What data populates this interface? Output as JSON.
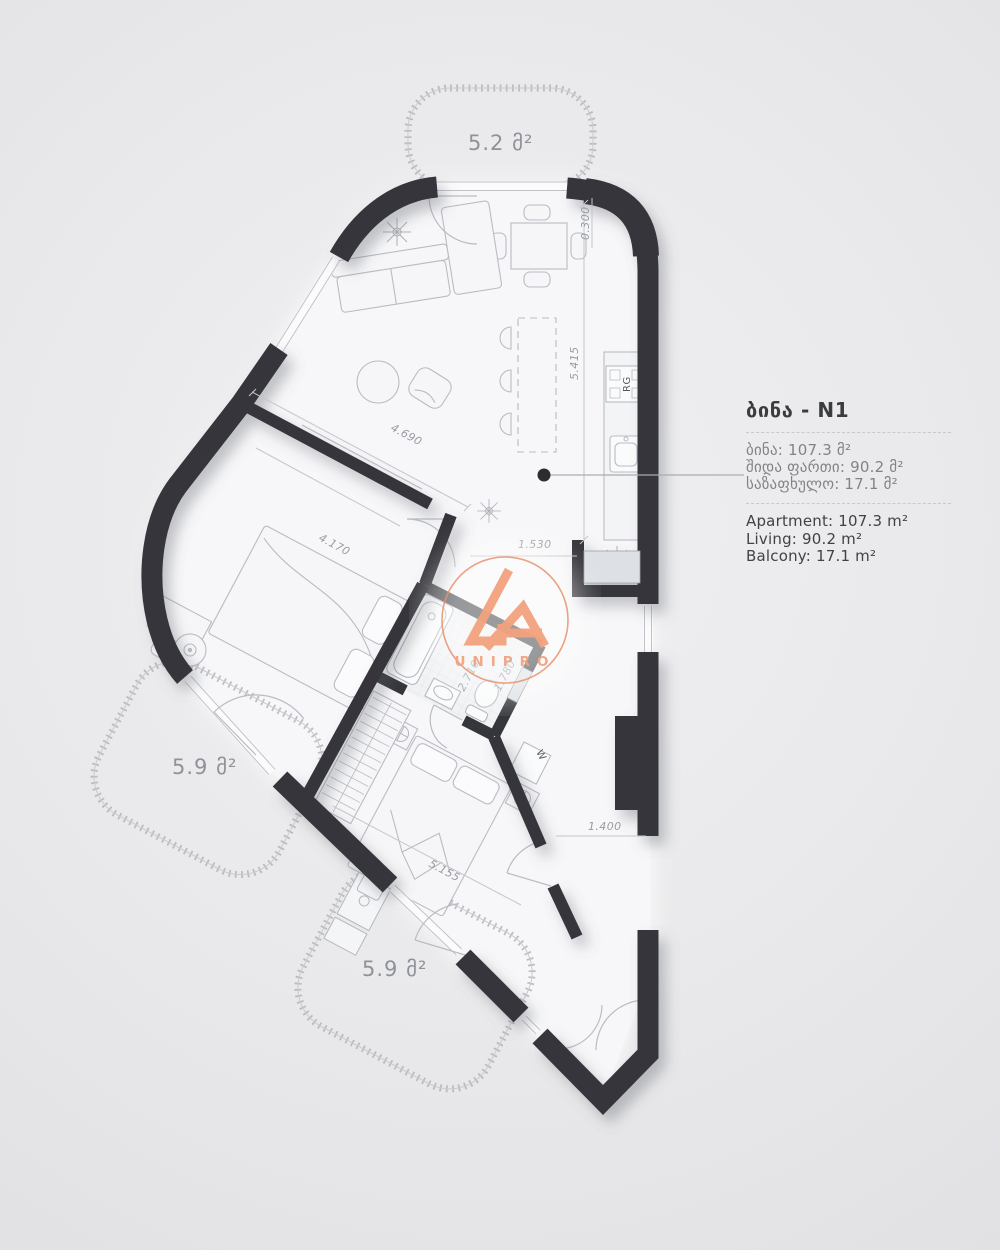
{
  "colors": {
    "background": "#e9e9eb",
    "wall": "#34363b",
    "accent": "#f0a07c",
    "line": "#b9bcc3"
  },
  "plan": {
    "balconies": [
      {
        "id": "top",
        "label": "5.2 მ²"
      },
      {
        "id": "left",
        "label": "5.9 მ²"
      },
      {
        "id": "bottom",
        "label": "5.9 მ²"
      }
    ],
    "dimensions": [
      "4.690",
      "4.170",
      "5.415",
      "0.300",
      "1.530",
      "2.710",
      "1.780",
      "5.155",
      "1.400"
    ],
    "appliances": {
      "range": "RG",
      "washer": "W"
    }
  },
  "logo": {
    "name": "UNIPRO"
  },
  "panel": {
    "title": "ბინა - N1",
    "lines_ka": [
      "ბინა: 107.3 მ²",
      "შიდა ფართი: 90.2 მ²",
      "საზაფხულო: 17.1 მ²"
    ],
    "lines_en": [
      "Apartment: 107.3 m²",
      "Living: 90.2 m²",
      "Balcony: 17.1 m²"
    ]
  }
}
